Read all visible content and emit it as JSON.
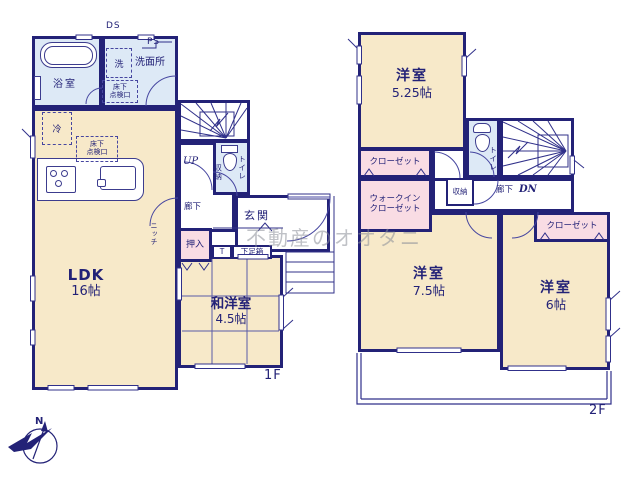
{
  "palette": {
    "wall": "#232277",
    "floor_cream": "#f7e9c9",
    "wet_blue": "#dde9f6",
    "closet_pink": "#f9dce4",
    "line": "#30308a",
    "watermark_gray": "#8b8f98"
  },
  "watermark": {
    "text": "不動産のオオタニ"
  },
  "compass": {
    "north_label": "N"
  },
  "floor1": {
    "floor_label": "1F",
    "duct": "DS",
    "pipe": "PS",
    "bathroom": {
      "label": "浴室"
    },
    "washroom": {
      "label": "洗面所",
      "washer": "洗",
      "hatch": {
        "line1": "床下",
        "line2": "点検口"
      }
    },
    "ldk": {
      "label": "LDK",
      "size": "16帖",
      "fridge": "冷",
      "niche": "ニッチ",
      "hatch": {
        "line1": "床下",
        "line2": "点検口"
      }
    },
    "stairs": {
      "label": "UP"
    },
    "toilet": {
      "label": "トイレ",
      "storage": "収納"
    },
    "hallway": {
      "label": "廊下"
    },
    "entrance": {
      "label": "玄関"
    },
    "oshiire": {
      "label": "押入"
    },
    "t_box": {
      "label": "T"
    },
    "shoe_box": {
      "label": "下足箱"
    },
    "washitsu": {
      "label": "和洋室",
      "size": "4.5帖"
    }
  },
  "floor2": {
    "floor_label": "2F",
    "bedroom1": {
      "label": "洋室",
      "size": "5.25帖"
    },
    "closet1": {
      "label": "クローゼット"
    },
    "wic": {
      "line1": "ウォークイン",
      "line2": "クローゼット"
    },
    "toilet": {
      "label": "トイレ"
    },
    "storage": {
      "label": "収納"
    },
    "hallway": {
      "label": "廊下"
    },
    "stairs": {
      "label": "DN"
    },
    "bedroom2": {
      "label": "洋室",
      "size": "7.5帖"
    },
    "bedroom3": {
      "label": "洋室",
      "size": "6帖"
    },
    "closet2": {
      "label": "クローゼット"
    }
  }
}
